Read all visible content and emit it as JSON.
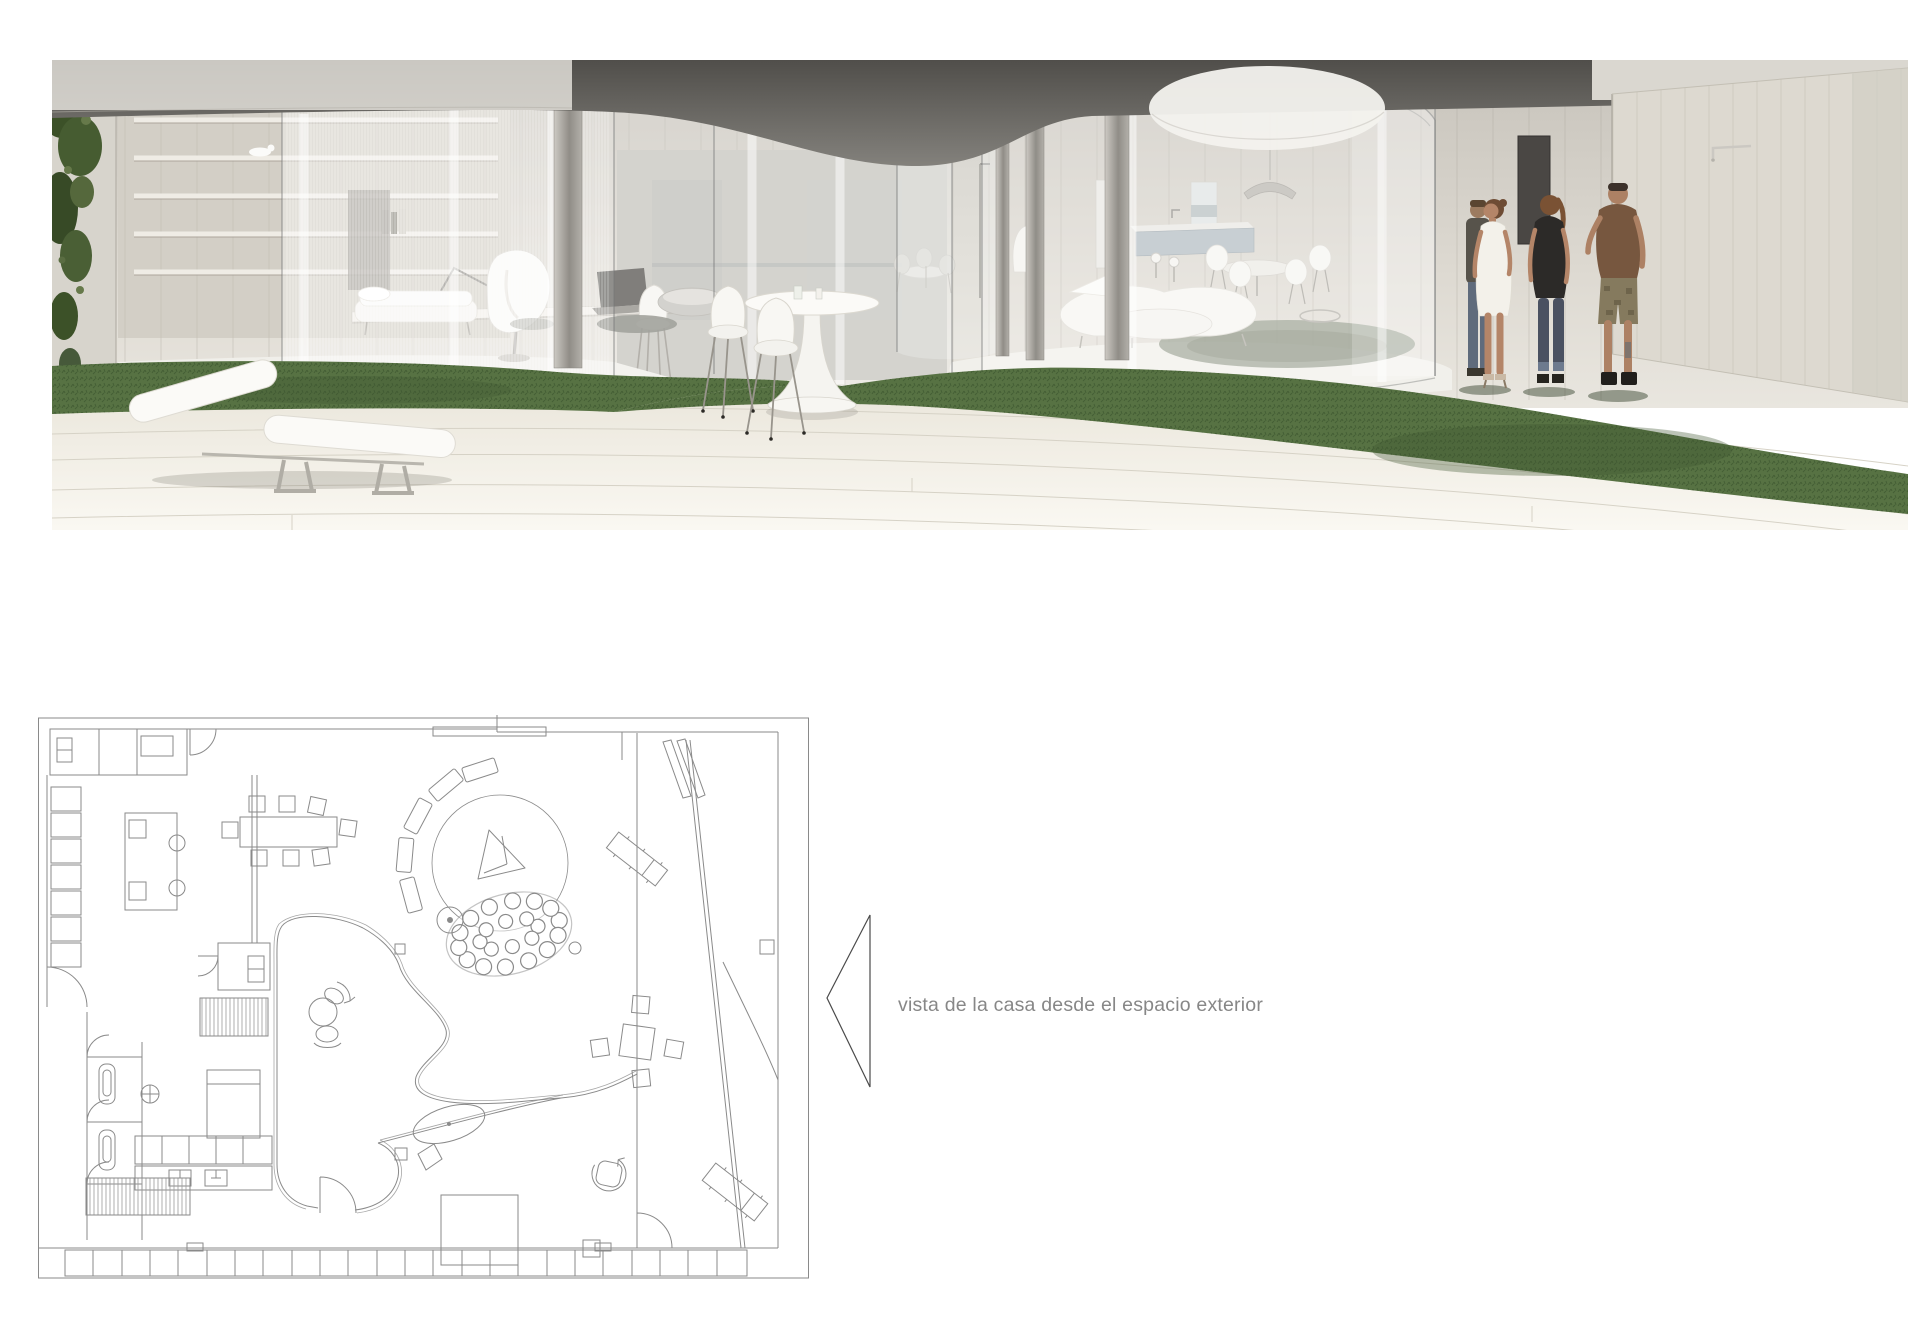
{
  "caption": {
    "text": "vista de la casa desde el espacio exterior"
  },
  "view_marker": {
    "icon": "left-triangle-outline",
    "direction": "left"
  },
  "palette": {
    "page_bg": "#ffffff",
    "caption_text": "#878787",
    "plan_line": "#8a8a8a",
    "arrow_line": "#4a4a4a",
    "grass": "#577243",
    "grass_dark": "#324b26",
    "ivy": "#41572f",
    "wall_wood": "#d9d5cc",
    "ceiling_dark": "#5c5a55",
    "deck": "#f3f0e8",
    "glass_tint": "#eef1f2",
    "furniture_white": "#f7f6f2",
    "kitchen_island": "#b3bdc3",
    "tshirt_brown": "#77573f",
    "top_black": "#2c2a28",
    "jeans": "#4a5161",
    "dress_white": "#f3f1ea",
    "shorts_khaki": "#857a5e",
    "skin": "#b08266"
  }
}
